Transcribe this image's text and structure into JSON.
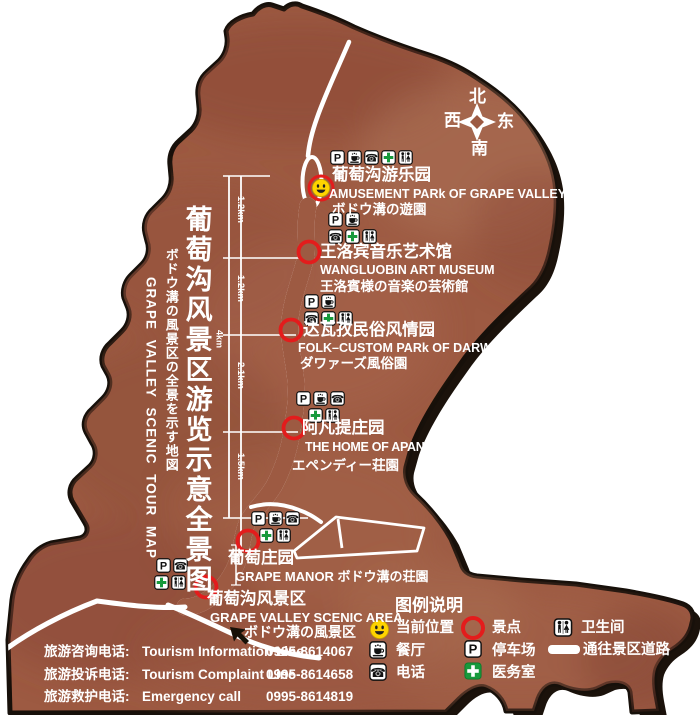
{
  "colors": {
    "map_fill": "#9d5a42",
    "map_border": "#17100a",
    "road_white": "#ffffff",
    "marker_red": "#e31c1c",
    "medical_green": "#179a3c",
    "smiley_yellow": "#ffd400",
    "text_white": "#ffffff"
  },
  "icons": {
    "parking_letter": "P",
    "phone_glyph": "☎"
  },
  "titles": {
    "cn": "葡萄沟风景区游览示意全景图",
    "jp": "ボドウ溝の風景区の全景を示す地図",
    "en": "GRAPE VALLEY SCENIC TOUR MAP"
  },
  "compass": {
    "north": "北",
    "south": "南",
    "east": "东",
    "west": "西"
  },
  "attractions": {
    "amusement": {
      "cn": "葡萄沟游乐园",
      "en": "AMUSEMENT PARk OF GRAPE VALLEY",
      "jp": "ボドウ溝の遊園"
    },
    "museum": {
      "cn": "王洛宾音乐艺术馆",
      "en": "WANGLUOBIN ART MUSEUM",
      "jp": "王洛賓様の音楽の芸術館"
    },
    "darwaz": {
      "cn": "达瓦孜民俗风情园",
      "en": "FOLK–CUSTOM PARk OF DARWAZ",
      "jp": "ダワァーズ風俗園"
    },
    "apandi": {
      "cn": "阿凡提庄园",
      "en": "THE HOME OF APANDI",
      "jp": "エペンディー荘園"
    },
    "manor": {
      "cn": "葡萄庄园",
      "en": "GRAPE MANOR ボドウ溝の荘園"
    },
    "scenic_area": {
      "cn": "葡萄沟风景区",
      "en": "GRAPE VALLEY SCENIC AREA",
      "jp": "ボドウ溝の風景区"
    }
  },
  "distances": {
    "seg1": "1.2km",
    "seg2": "1.2km",
    "seg3": "2.1km",
    "seg4": "1.5km",
    "total": "4km"
  },
  "legend": {
    "title": "图例说明",
    "current_location": "当前位置",
    "restaurant": "餐厅",
    "phone": "电话",
    "scenic_spot": "景点",
    "parking": "停车场",
    "medical": "医务室",
    "toilet": "卫生间",
    "road": "通往景区道路"
  },
  "phones": {
    "info": {
      "cn": "旅游咨询电话:",
      "en": "Tourism Information Line",
      "number": "0995-8614067"
    },
    "complaint": {
      "cn": "旅游投诉电话:",
      "en": "Tourism  Complaint  Line",
      "number": "0995-8614658"
    },
    "emergency": {
      "cn": "旅游救护电话:",
      "en": "Emergency  call",
      "number": "0995-8614819"
    }
  }
}
